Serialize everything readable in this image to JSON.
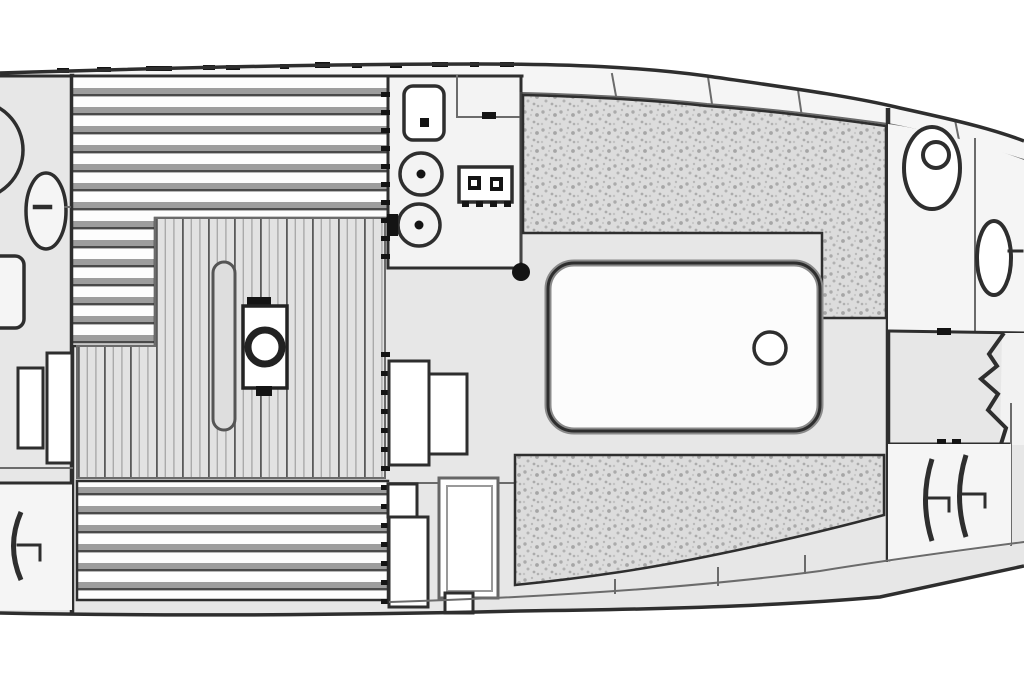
{
  "diagram": {
    "type": "floor-plan",
    "subject": "sailboat-interior-layout-top-view",
    "orientation": {
      "bow": "right",
      "stern": "left",
      "cropped_edges": [
        "left",
        "right"
      ]
    },
    "text_labels": [],
    "colors": {
      "background": "#ffffff",
      "line": "#2e2e2e",
      "line_soft": "#6b6b6b",
      "interior": "#e7e7e7",
      "room_white": "#f5f5f5",
      "counter": "#f3f3f3",
      "slat_light": "#fdfdfd",
      "slat_gray": "#9d9d9d",
      "slat_dark": "#4a4a4a",
      "plank_bg": "#e2e2e2",
      "plank_line": "#aaaaaa",
      "plank_dark": "#5a5a5a",
      "cushion_bg": "#dcdcdc",
      "cushion_dot": "#ababab",
      "table_fill": "#fcfcfc",
      "table_shadow": "#8a8a8a",
      "black": "#141414"
    },
    "areas": {
      "aft_cabin": {
        "fixtures": [
          "aft-porthole-fixture",
          "aft-washbasin",
          "aft-locker-door",
          "aft-seat-steps",
          "aft-hanging-locker",
          "hanger-symbol"
        ]
      },
      "saloon": {
        "fixtures": [
          "berth-upper-slats",
          "berth-lower-slats",
          "cabin-sole-planks",
          "table-leaf",
          "cabin-heater",
          "mast-post",
          "saloon-table",
          "table-ring",
          "settee-upper-cushion",
          "settee-lower-cushion",
          "companionway-steps"
        ]
      },
      "galley": {
        "fixtures": [
          "galley-counter",
          "galley-sink",
          "galley-burner-1",
          "galley-burner-2",
          "galley-stove",
          "stove-knobs",
          "icebox-lid",
          "louver-dashes"
        ]
      },
      "fwd_head": {
        "fixtures": [
          "head-toilet",
          "head-washbasin",
          "head-divider"
        ]
      },
      "bow": {
        "fixtures": [
          "bow-walkway",
          "chain-locker-chevron",
          "fwd-hanging-locker-1",
          "fwd-hanging-locker-2"
        ]
      },
      "hull": {
        "fixtures": [
          "hull-outline",
          "inner-sheer-line",
          "sheer-locker-boxes",
          "sheer-dashes",
          "fwd-bulkhead",
          "hull-bottom-lockers"
        ]
      }
    }
  }
}
